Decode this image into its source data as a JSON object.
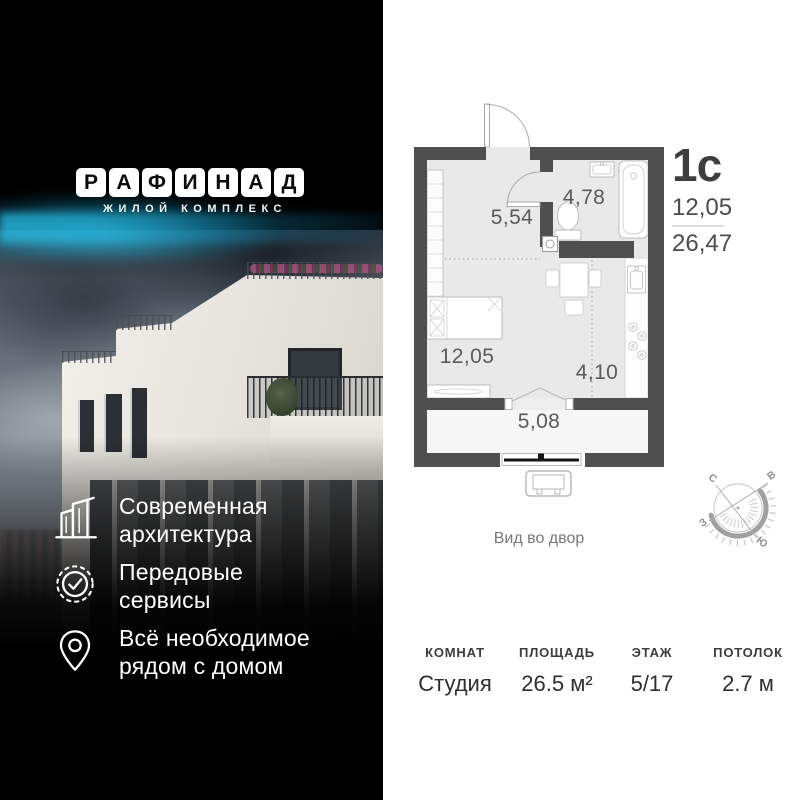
{
  "brand": {
    "logo_letters": [
      "Р",
      "А",
      "Ф",
      "И",
      "Н",
      "А",
      "Д"
    ],
    "subtitle": "ЖИЛОЙ КОМПЛЕКС",
    "glow_color": "#1fbcd9"
  },
  "features": [
    {
      "icon": "modern-architecture-icon",
      "lines": [
        "Современная",
        "архитектура"
      ]
    },
    {
      "icon": "badge-check-icon",
      "lines": [
        "Передовые",
        "сервисы"
      ]
    },
    {
      "icon": "map-pin-icon",
      "lines": [
        "Всё необходимое",
        "рядом с домом"
      ]
    }
  ],
  "plan": {
    "unit_type": "1с",
    "area_living": "12,05",
    "area_total": "26,47",
    "rooms": {
      "hallway": "5,54",
      "bathroom": "4,78",
      "living": "12,05",
      "kitchen": "4,10",
      "balcony": "5,08"
    },
    "view_caption": "Вид во двор",
    "compass": {
      "north": "С",
      "east": "В",
      "west": "З",
      "south": "Ю"
    },
    "wall_color": "#4f4f4f",
    "floor_color": "#e9e9e9"
  },
  "specs": {
    "columns": [
      {
        "label": "КОМНАТ",
        "value": "Студия"
      },
      {
        "label": "ПЛОЩАДЬ",
        "value": "26.5 м²"
      },
      {
        "label": "ЭТАЖ",
        "value": "5/17"
      },
      {
        "label": "ПОТОЛОК",
        "value": "2.7 м"
      }
    ]
  }
}
